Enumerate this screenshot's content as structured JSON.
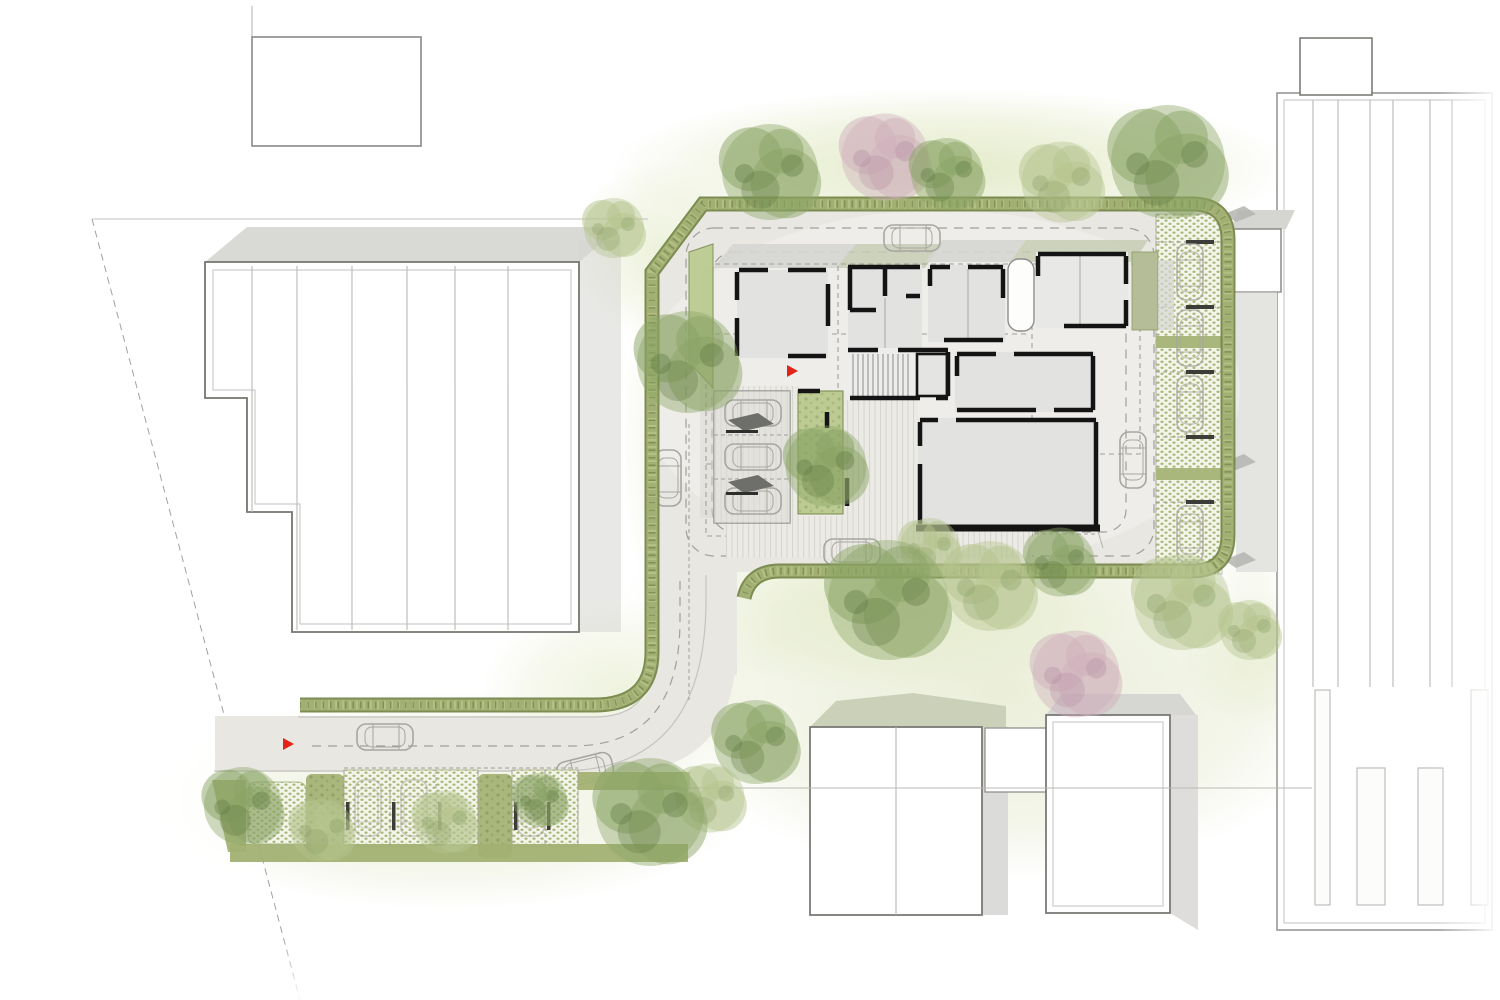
{
  "meta": {
    "title": "Architectural site plan — ground floor",
    "type": "architectural-site-plan",
    "style": "watercolor line drawing, top view"
  },
  "palette": {
    "paper": "#ffffff",
    "paving": "#e9e7e2",
    "road_edge": "#c6c4c0",
    "dash": "#a19f9b",
    "hedge": "#a2b173",
    "hedge_light": "#b6c287",
    "hedge_dark": "#76864a",
    "hedge_deep": "#5f6e3a",
    "grass": "#dce5ba",
    "meadow": "#e7ecd3",
    "permeable_base": "#f4f5ea",
    "permeable_dot": "#a9b87a",
    "island": "#a9b77c",
    "courtyard": "#bccb92",
    "tree_green": "#8aa465",
    "tree_green_dark": "#5f7a42",
    "tree_light": "#b5c48e",
    "tree_light_dark": "#8fa369",
    "tree_pink": "#cfafbc",
    "tree_pink_dark": "#b48fa2",
    "roof_shadow": "#d5d5d2",
    "roof_shadow_green": "#c6cdb4",
    "building_fill": "#ffffff",
    "building_outline": "#76746f",
    "inner_line": "#c2c2c0",
    "panel_line": "#b9b9b6",
    "room_fill": "#e2e2e1",
    "core_fill": "#ededec",
    "wall": "#141414",
    "deck_base": "#eceae5",
    "deck_line": "#d8d6d0",
    "carport_fill": "#dcdbd7",
    "canopy": "#6e6e6a",
    "car": "#a8a6a1",
    "wheel_stop": "#3c3c38",
    "red": "#e02418",
    "yard": "#e4e4e0"
  },
  "inventory": {
    "proposed_building": {
      "room_wings": 6,
      "stair_core": 1,
      "elevator": 1,
      "entry_canopy": 1,
      "courtyard_garden": 1,
      "green_roof_strips": 2
    },
    "context_buildings": {
      "northwest_hall_roof_panels": 6,
      "north_cottage": 1,
      "east_hall_skylight_strips": 4,
      "east_annex": 1,
      "south_houses": 2
    },
    "parking": {
      "east_permeable_stalls": 6,
      "south_permeable_stalls": 6,
      "carport_stalls": 3,
      "cars_drawn": 16,
      "wheel_stops": 11
    },
    "landscape": {
      "trees": 22,
      "hedge_border": true,
      "permeable_paving_areas": 4,
      "green_islands": 3
    },
    "markers": {
      "entrance_arrows": 2
    }
  }
}
